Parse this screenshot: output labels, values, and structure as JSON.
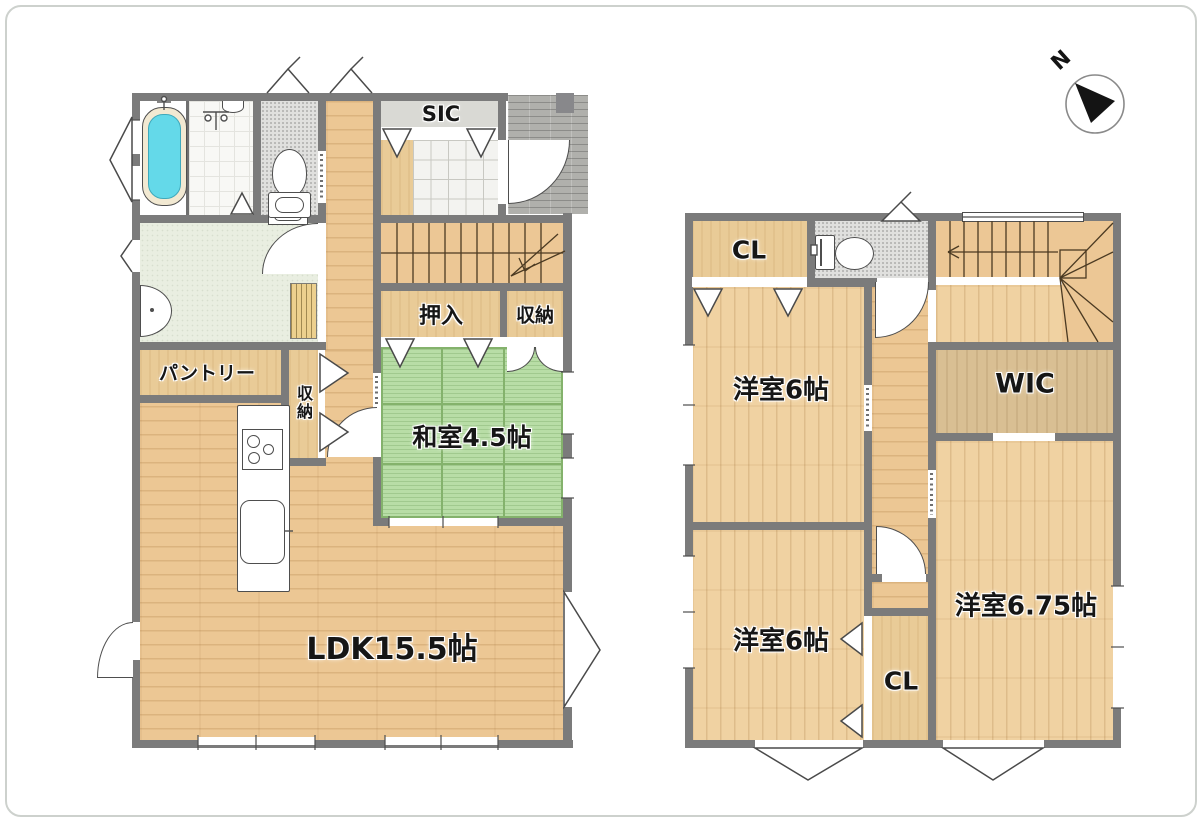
{
  "compass": {
    "north_label": "N"
  },
  "floor1": {
    "rooms": {
      "sic": "SIC",
      "oshiire": "押入",
      "storage_main": "収納",
      "storage_kitchen": "収納",
      "pantry": "パントリー",
      "japanese_room": "和室4.5帖",
      "ldk": "LDK15.5帖"
    }
  },
  "floor2": {
    "rooms": {
      "closet_top": "CL",
      "closet_bottom": "CL",
      "walk_in_closet": "WIC",
      "bedroom_top": "洋室6帖",
      "bedroom_bottom": "洋室6帖",
      "bedroom_right": "洋室6.75帖"
    }
  },
  "colors": {
    "wall": "#7b7b7b",
    "wood_floor": "#ecc794",
    "tatami": "#b8dda6",
    "bath_water": "#64d9e9",
    "closet_tan": "#e9cb97"
  }
}
